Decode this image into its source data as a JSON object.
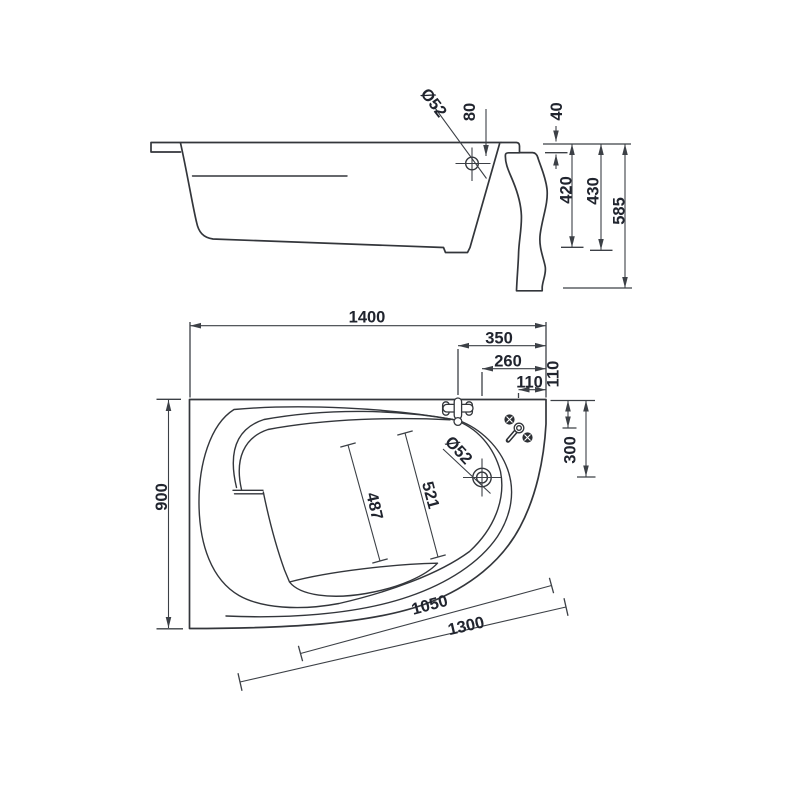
{
  "title": "Corner bathtub technical drawing",
  "colors": {
    "background": "#ffffff",
    "line": "#33363b",
    "dimension": "#3c4046",
    "text": "#20242e"
  },
  "side_view": {
    "label": "side elevation",
    "dims": {
      "drain_diameter": "Ø52",
      "drain_center_from_rim": "80",
      "rim_band_height": "40",
      "inner_depth": "420",
      "outer_depth": "430",
      "overall_height": "585"
    }
  },
  "plan_view": {
    "label": "top plan view",
    "dims": {
      "overall_length": "1400",
      "faucet_from_right": "350",
      "drain_from_right": "260",
      "handles_from_right": "110",
      "handles_from_top": "110",
      "drain_from_top": "300",
      "overall_width": "900",
      "drain_diameter": "Ø52",
      "basin_floor_long": "521",
      "basin_floor_short": "487",
      "front_edge_inner": "1050",
      "front_edge_outer": "1300"
    }
  }
}
